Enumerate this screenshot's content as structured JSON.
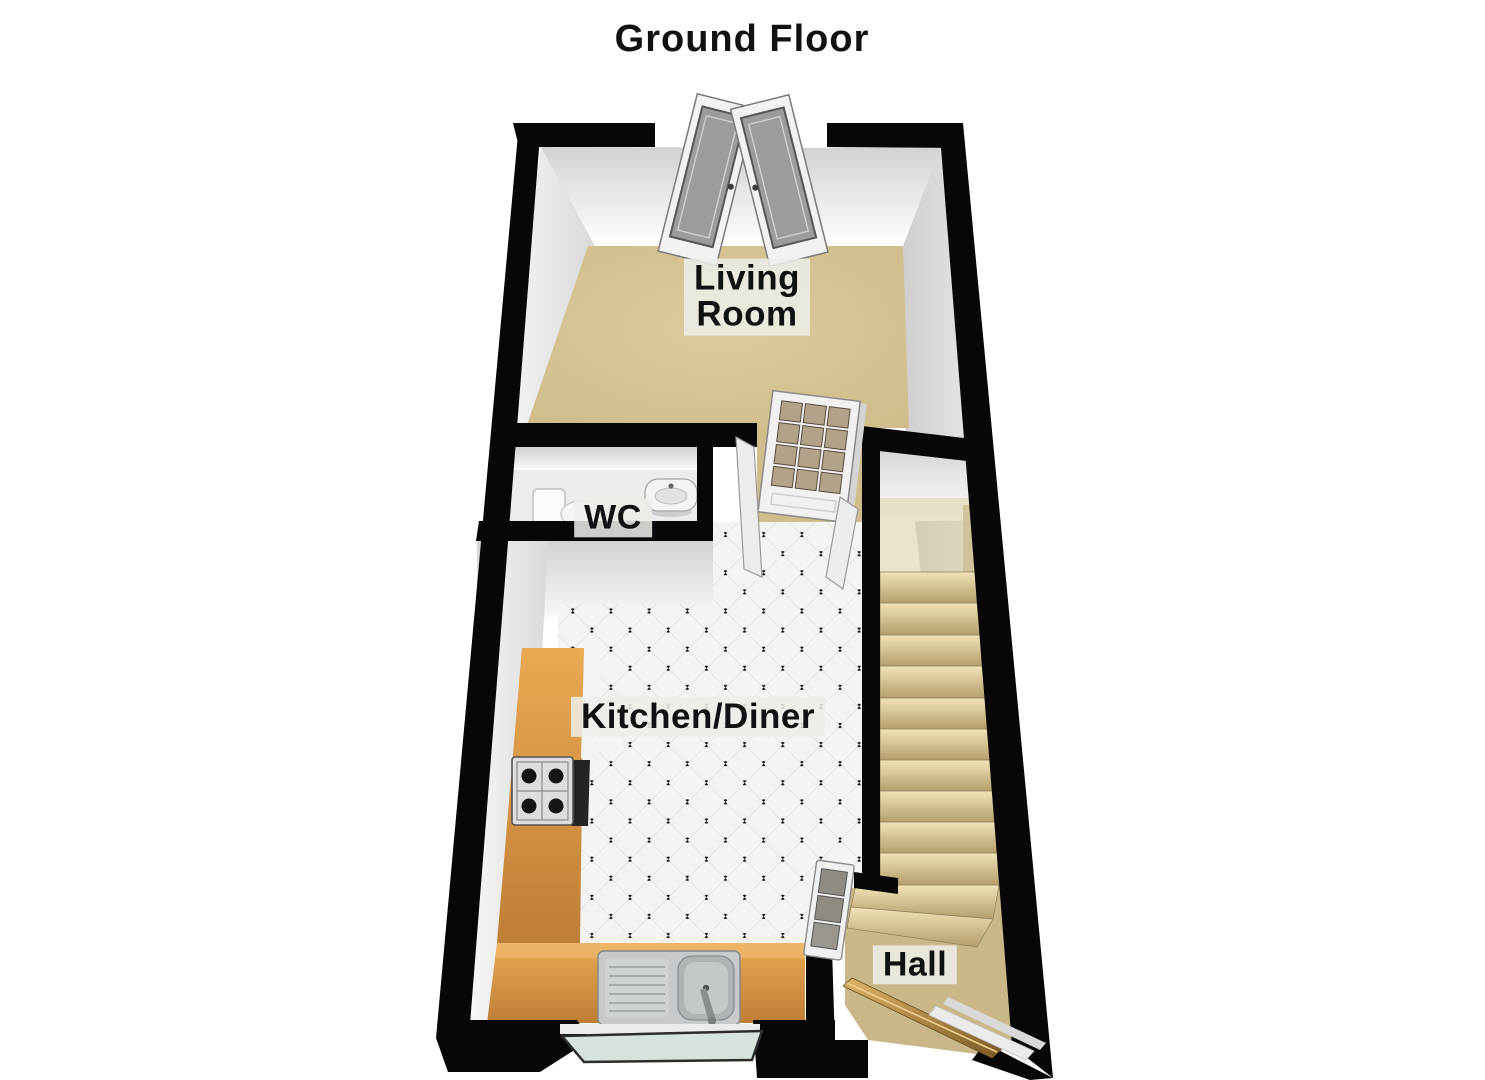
{
  "floorplan": {
    "title": "Ground Floor",
    "rooms": {
      "living_room": {
        "label": "Living\nRoom"
      },
      "wc": {
        "label": "WC"
      },
      "kitchen_diner": {
        "label": "Kitchen/Diner"
      },
      "hall": {
        "label": "Hall"
      }
    },
    "fixtures": [
      "double-entry-doors",
      "glazed-internal-door",
      "wc-door",
      "internal-door-leaf",
      "louvered-door",
      "front-door",
      "window",
      "staircase",
      "stair-landing",
      "toilet",
      "wash-basin",
      "kitchen-counter",
      "gas-hob",
      "oven",
      "sink-with-drainer",
      "door-threshold"
    ],
    "colors": {
      "wall": "#0a0a0a",
      "carpet_living": "#d5c391",
      "carpet_hall": "#c9b787",
      "tile_base": "#f4f4f2",
      "tile_line": "#dcdcda",
      "tile_dot": "#161616",
      "counter_wood": "#df9d49",
      "stair_tread": "#e8d8a6",
      "front_door_wood": "#c59a55",
      "window_glass": "#d7e4dc",
      "door_panel_grey": "#9c9c9c",
      "glazed_pane": "#b2a28a"
    }
  }
}
